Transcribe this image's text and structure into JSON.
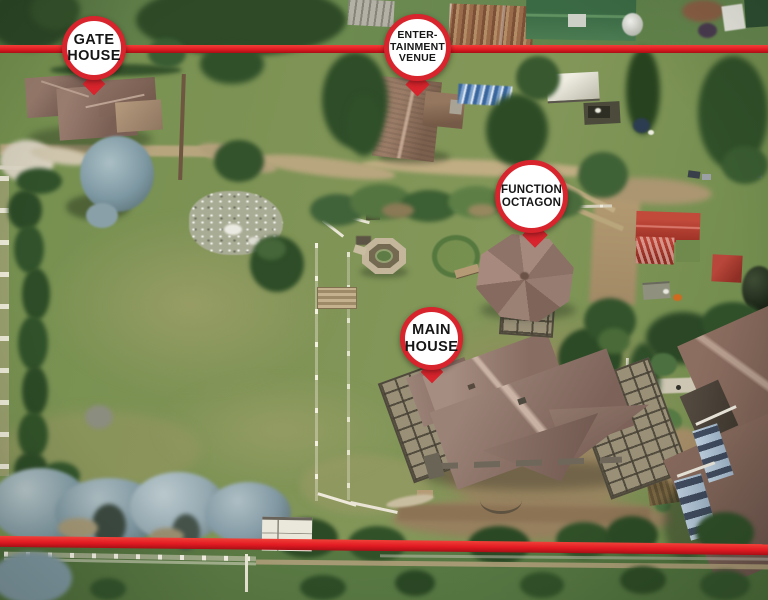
{
  "scene": {
    "type": "aerial-property-photo",
    "description": "Aerial drone view of a farm property with red boundary lines and labeled buildings"
  },
  "pins": [
    {
      "id": "gate-house",
      "lines": [
        "GATE",
        "HOUSE"
      ]
    },
    {
      "id": "entertainment-venue",
      "lines": [
        "ENTER-",
        "TAINMENT",
        "VENUE"
      ]
    },
    {
      "id": "function-octagon",
      "lines": [
        "FUNCTION",
        "OCTAGON"
      ]
    },
    {
      "id": "main-house",
      "lines": [
        "MAIN",
        "HOUSE"
      ]
    }
  ],
  "colors": {
    "boundary_line": "#e21a22",
    "pin_ring": "#d8242c",
    "pin_fill": "#ffffff",
    "pin_text": "#161616"
  }
}
